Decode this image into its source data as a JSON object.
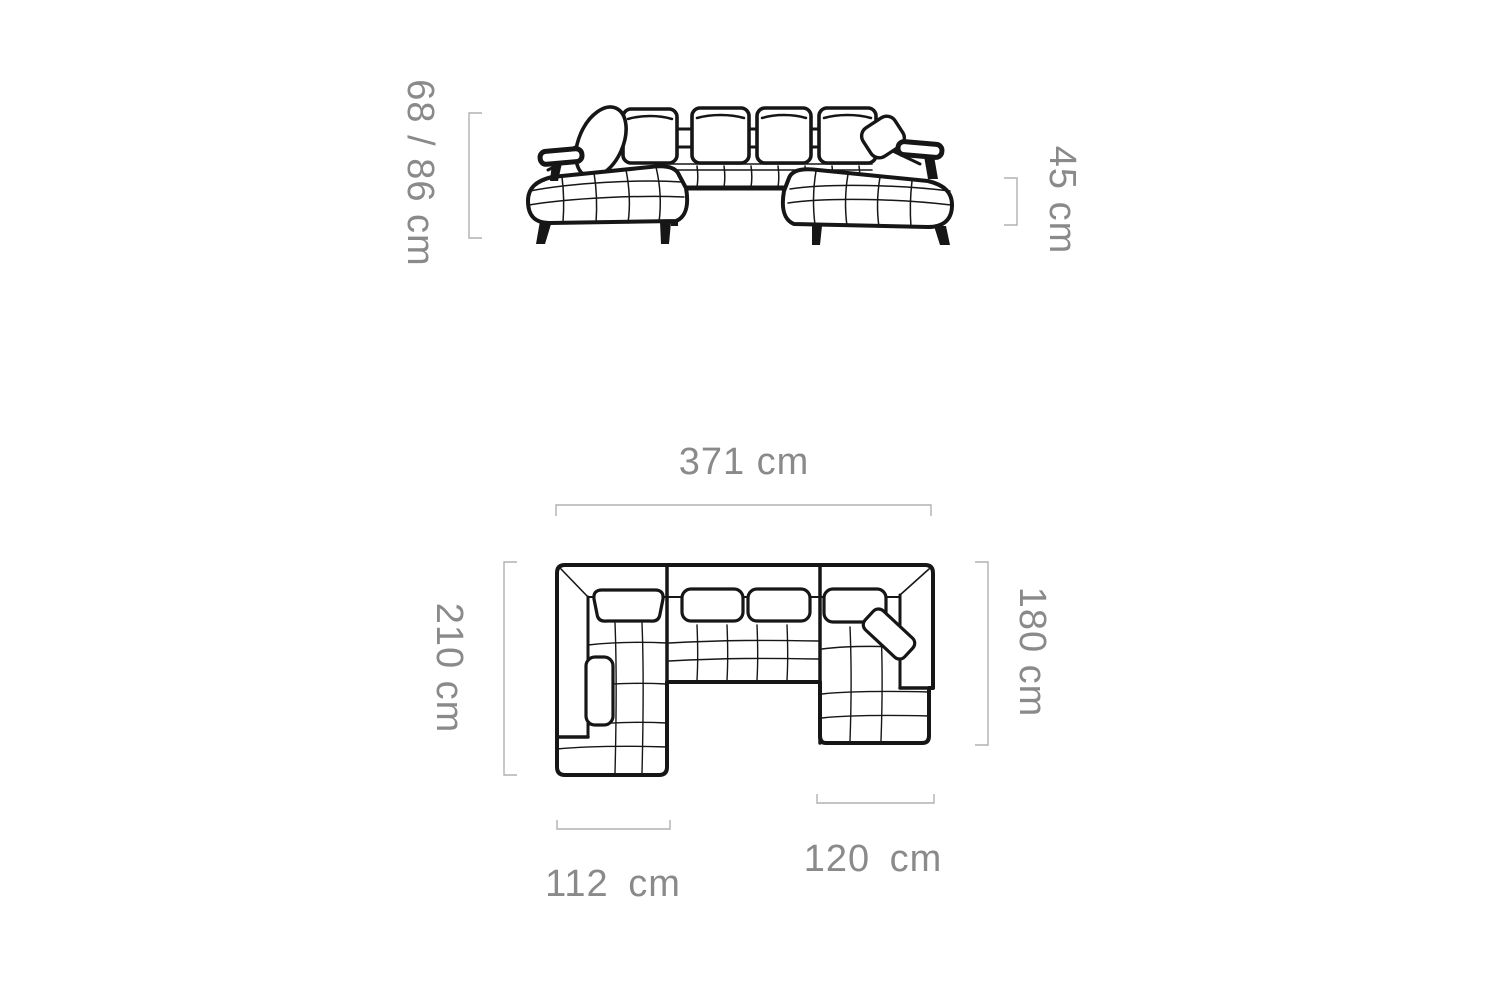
{
  "diagram": {
    "subject": "u-shaped-corner-sofa",
    "views": {
      "front_elevation": "front view drawing",
      "top_plan": "top plan drawing"
    },
    "dimensions": {
      "overall_height": {
        "label": "68 / 86 cm"
      },
      "seat_height": {
        "label": "45 cm"
      },
      "overall_width": {
        "label": "371 cm"
      },
      "left_side_depth": {
        "label": "210 cm"
      },
      "right_side_depth": {
        "label": "180 cm"
      },
      "left_chaise_width": {
        "label": "112 cm"
      },
      "right_chaise_width": {
        "label": "120 cm"
      }
    },
    "colors": {
      "background": "#ffffff",
      "sofa_line": "#161616",
      "dimension_text": "#8a8a8a",
      "dimension_line": "#b0b0b0"
    }
  }
}
